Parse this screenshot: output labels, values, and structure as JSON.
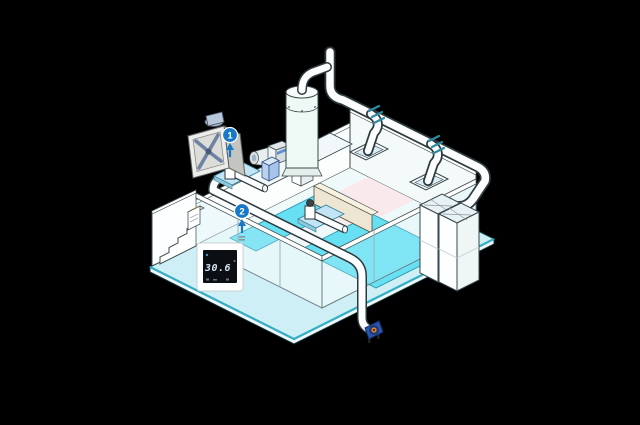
{
  "canvas": {
    "width": 640,
    "height": 425,
    "background": "#000000"
  },
  "annotations": {
    "badge_color": "#1878c8",
    "badges": [
      {
        "label": "1"
      },
      {
        "label": "2"
      }
    ]
  },
  "thermostat": {
    "reading": "30.6",
    "degree": "°"
  },
  "colors": {
    "pool_water": "#66e0f2",
    "deck": "#cdeff5",
    "deck_edge": "#35aec4",
    "interior_floor": "#f0f9fa",
    "wall_white": "#fcfdfd",
    "beige_wall": "#eee6d2",
    "pink_floor": "#f9e8ec",
    "duct_fill": "#fbfdfe",
    "duct_outline": "#2e3a3e",
    "coupling_teal": "#2e8ba2",
    "mount_plate_blue": "#c2e4f4",
    "end_fan_body": "#2c55a8",
    "end_fan_impeller": "#e87c1e",
    "thermostat_screen": "#0b0e13",
    "thermostat_text": "#d6e4f4",
    "wall_fan_grey": "#ececea"
  },
  "components": [
    {
      "name": "wall-exhaust-fan-icon"
    },
    {
      "name": "filter-tank-icon"
    },
    {
      "name": "circulation-pump-icon"
    },
    {
      "name": "control-cabinet-icon"
    },
    {
      "name": "duct-run-back"
    },
    {
      "name": "duct-run-front"
    },
    {
      "name": "floor-vent-plate"
    },
    {
      "name": "air-handling-unit"
    },
    {
      "name": "valve-elbow"
    },
    {
      "name": "thermostat-panel"
    },
    {
      "name": "wall-dispenser-icon"
    },
    {
      "name": "end-blower-fan-icon"
    },
    {
      "name": "stairs"
    },
    {
      "name": "pool-water"
    }
  ]
}
